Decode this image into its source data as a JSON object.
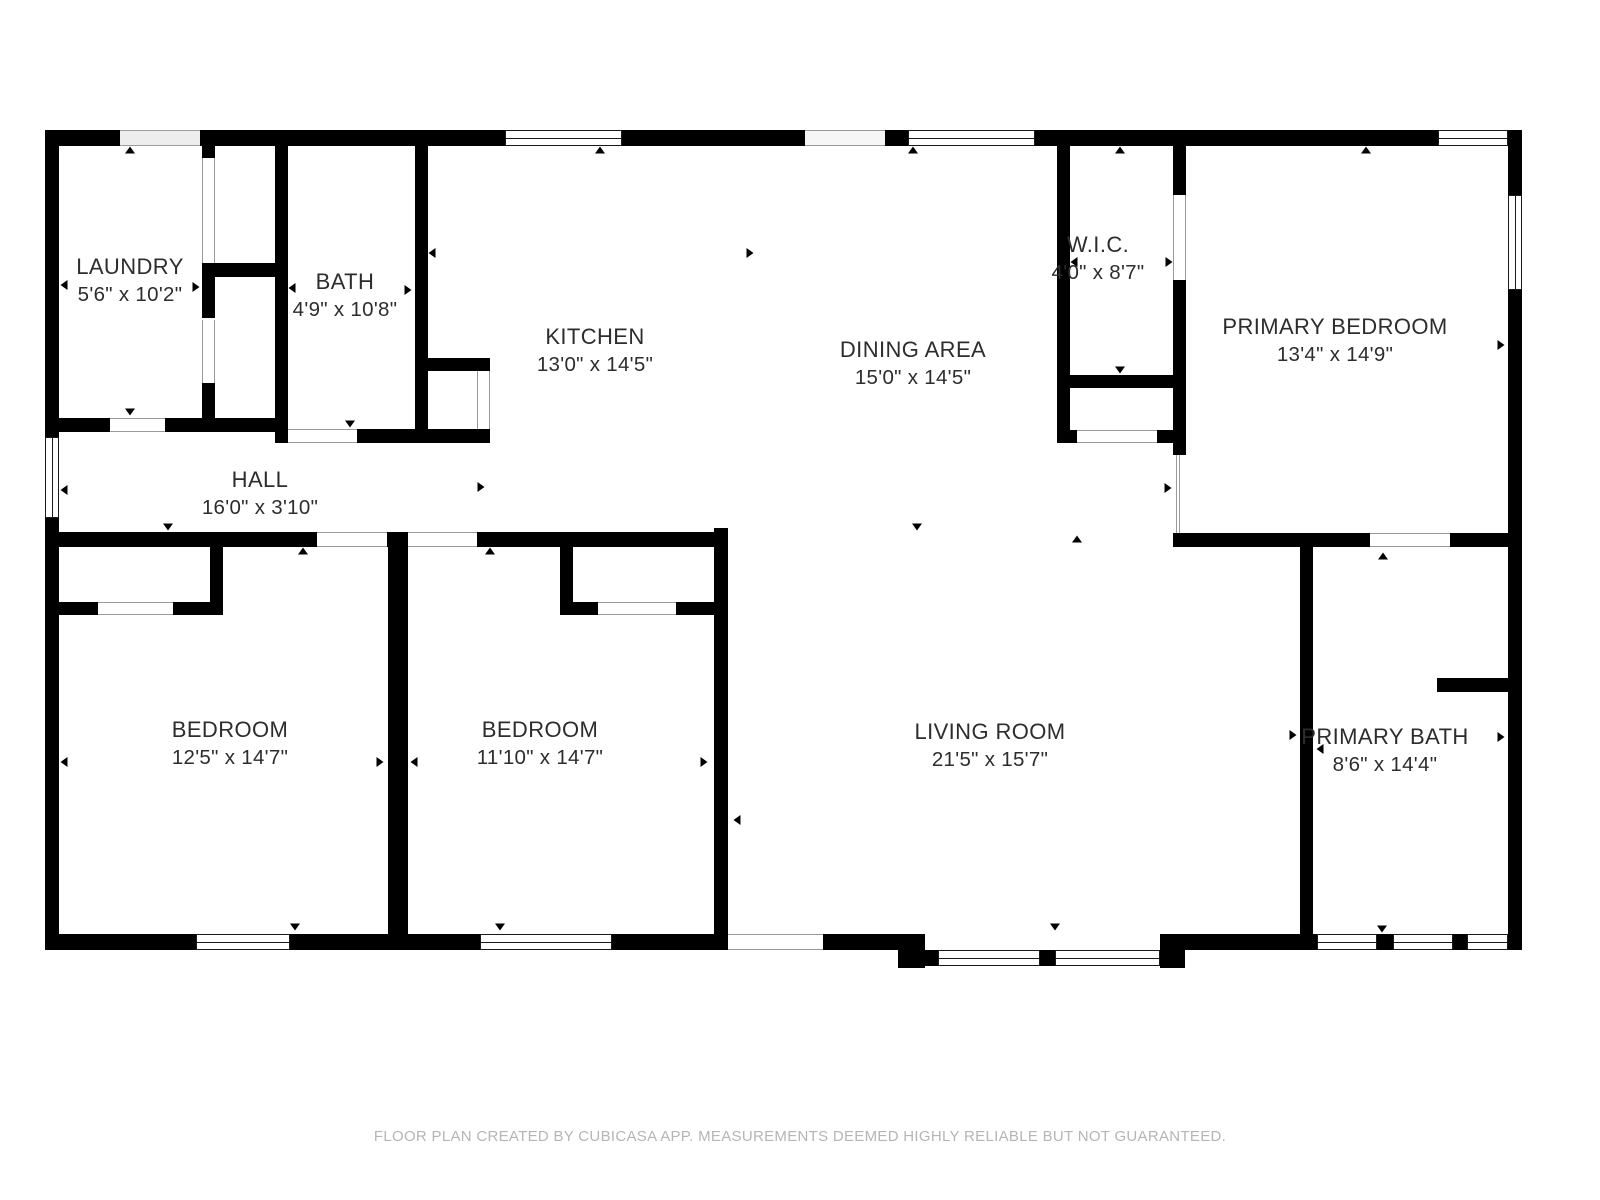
{
  "colors": {
    "wall": "#000000",
    "window_frame": "#1a1a1a",
    "opening_line": "#9a9a9a",
    "label_text": "#2d2d2d",
    "footer_text": "#b5b5b5",
    "background": "#ffffff"
  },
  "rooms": [
    {
      "id": "laundry",
      "name": "LAUNDRY",
      "dims": "5'6\" x 10'2\""
    },
    {
      "id": "bath",
      "name": "BATH",
      "dims": "4'9\" x 10'8\""
    },
    {
      "id": "kitchen",
      "name": "KITCHEN",
      "dims": "13'0\" x 14'5\""
    },
    {
      "id": "dining-area",
      "name": "DINING AREA",
      "dims": "15'0\" x 14'5\""
    },
    {
      "id": "wic",
      "name": "W.I.C.",
      "dims": "4'0\" x 8'7\""
    },
    {
      "id": "primary-bedroom",
      "name": "PRIMARY BEDROOM",
      "dims": "13'4\" x 14'9\""
    },
    {
      "id": "hall",
      "name": "HALL",
      "dims": "16'0\" x 3'10\""
    },
    {
      "id": "bedroom-1",
      "name": "BEDROOM",
      "dims": "12'5\" x 14'7\""
    },
    {
      "id": "bedroom-2",
      "name": "BEDROOM",
      "dims": "11'10\" x 14'7\""
    },
    {
      "id": "living-room",
      "name": "LIVING ROOM",
      "dims": "21'5\" x 15'7\""
    },
    {
      "id": "primary-bath",
      "name": "PRIMARY BATH",
      "dims": "8'6\" x 14'4\""
    }
  ],
  "footer": "FLOOR PLAN CREATED BY CUBICASA APP. MEASUREMENTS DEEMED HIGHLY RELIABLE BUT NOT GUARANTEED."
}
